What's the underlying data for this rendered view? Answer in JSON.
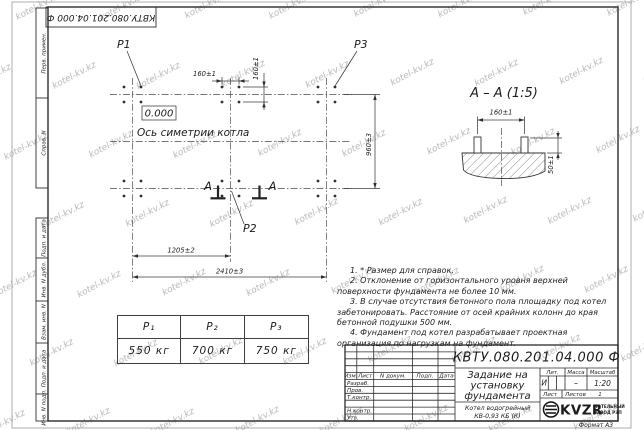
{
  "watermark": "kotel-kv.kz",
  "top_stamp": "КВТУ.080.201.04.000  Ф",
  "margin": {
    "labels": [
      "Перв. примен.",
      "Справ. N",
      "Подп. и дата",
      "Инв. N дубл.",
      "Взам. инв. N",
      "Подп. и дата",
      "Инв. N подл."
    ]
  },
  "plan": {
    "p1": "P1",
    "p2": "P2",
    "p3": "P3",
    "elevation": "0.000",
    "axis_label": "Ось симетрии котла",
    "dim_160_top": "160±1",
    "dim_160_side": "160±1",
    "dim_960": "960±3",
    "dim_1205": "1205±2",
    "dim_2410": "2410±3",
    "cut_letter_left": "А",
    "cut_letter_right": "А"
  },
  "section": {
    "title": "А – А (1:5)",
    "dim_160": "160±1",
    "dim_50": "50±1"
  },
  "notes": [
    "1. * Размер для справок.",
    "2. Отклонение от горизонтального уровня верхней поверхности фундамента не более 10 мм.",
    "3. В случае отсутствия бетонного пола площадку под котел забетонировать. Расстояние от осей крайних колонн до края бетонной подушки 500 мм.",
    "4. Фундамент под котел разрабатывает проектная организация по нагрузкам на фундамент."
  ],
  "load_table": {
    "columns": [
      {
        "header": "P₁",
        "value": "550 кг"
      },
      {
        "header": "P₂",
        "value": "700 кг"
      },
      {
        "header": "P₃",
        "value": "750 кг"
      }
    ]
  },
  "title_block": {
    "doc_number": "КВТУ.080.201.04.000  Ф",
    "title_line1": "Задание на",
    "title_line2": "установку",
    "title_line3": "фундамента",
    "product_line1": "Котел водогрейный",
    "product_line2": "КВ-0,93 КБ (К)",
    "col_izm": "Изм.",
    "col_list": "Лист",
    "col_ndoc": "N докум.",
    "col_podp": "Подп.",
    "col_data": "Дата",
    "row_razrab": "Разраб.",
    "row_prov": "Пров.",
    "row_tkontr": "Т.контр.",
    "row_nkontr": "Н.контр.",
    "row_utv": "Утв.",
    "lit_header": "Лит.",
    "mass_header": "Масса",
    "scale_header": "Масштаб",
    "lit_value": "И",
    "mass_value": "–",
    "scale_value": "1:20",
    "sheet_label": "Лист",
    "sheets_label": "Листов",
    "sheets_value": "1",
    "logo_text": "KVZR",
    "logo_caption_line1": "КОТЕЛЬНЫЙ",
    "logo_caption_line2": "ЗАВОД РЭП",
    "format_label": "Формат А3"
  }
}
